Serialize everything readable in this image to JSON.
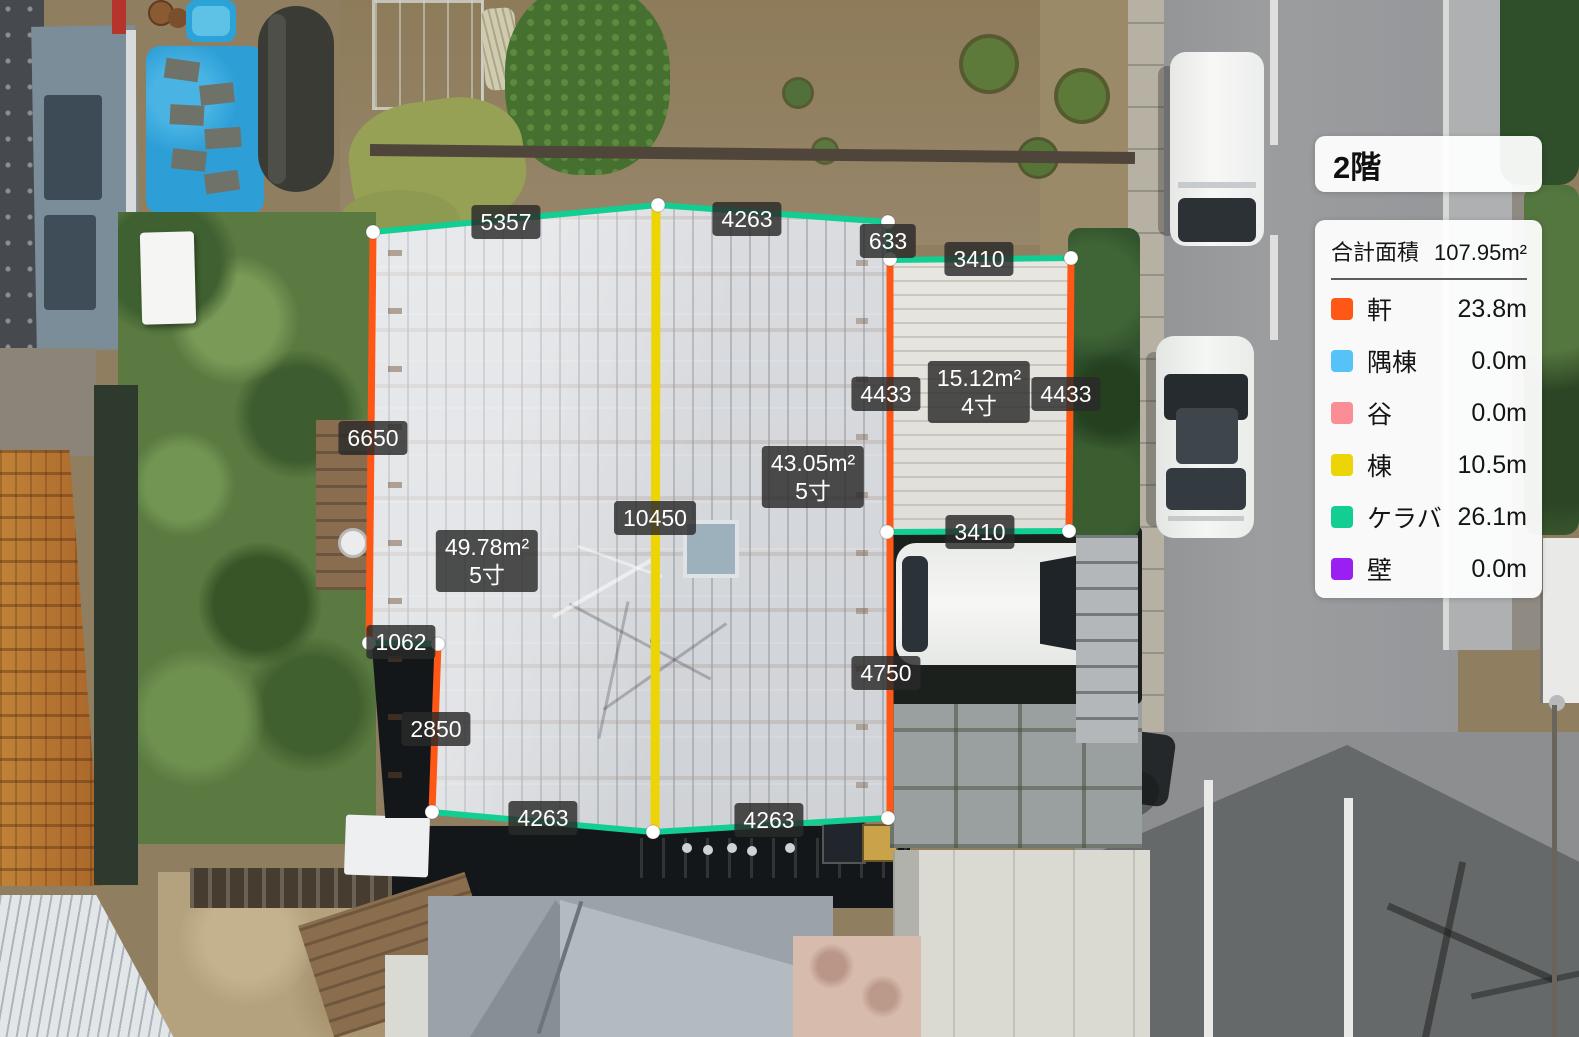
{
  "floor_panel": {
    "title": "2階"
  },
  "legend": {
    "total_label": "合計面積",
    "total_value": "107.95m²",
    "items": [
      {
        "key": "eave",
        "name": "軒",
        "value": "23.8m",
        "color": "#FF5716"
      },
      {
        "key": "hip-ridge",
        "name": "隅棟",
        "value": "0.0m",
        "color": "#55C3F8"
      },
      {
        "key": "valley",
        "name": "谷",
        "value": "0.0m",
        "color": "#FB8D96"
      },
      {
        "key": "ridge",
        "name": "棟",
        "value": "10.5m",
        "color": "#EDD405"
      },
      {
        "key": "gable",
        "name": "ケラバ",
        "value": "26.1m",
        "color": "#12CE92"
      },
      {
        "key": "wall",
        "name": "壁",
        "value": "0.0m",
        "color": "#9B1FF2"
      }
    ]
  },
  "overlay": {
    "edge_colors": {
      "eave": "#FF5716",
      "ridge": "#EDD405",
      "gable": "#12CE92"
    },
    "edge_widths": {
      "eave": 7,
      "ridge": 9,
      "gable": 6
    },
    "edges": [
      {
        "type": "gable",
        "x1": 373,
        "y1": 232,
        "x2": 658,
        "y2": 205
      },
      {
        "type": "gable",
        "x1": 658,
        "y1": 205,
        "x2": 888,
        "y2": 222
      },
      {
        "type": "gable",
        "x1": 888,
        "y1": 222,
        "x2": 890,
        "y2": 258
      },
      {
        "type": "eave",
        "x1": 373,
        "y1": 232,
        "x2": 369,
        "y2": 643
      },
      {
        "type": "gable",
        "x1": 369,
        "y1": 643,
        "x2": 438,
        "y2": 644
      },
      {
        "type": "eave",
        "x1": 438,
        "y1": 644,
        "x2": 432,
        "y2": 812
      },
      {
        "type": "gable",
        "x1": 432,
        "y1": 812,
        "x2": 653,
        "y2": 832
      },
      {
        "type": "gable",
        "x1": 653,
        "y1": 832,
        "x2": 888,
        "y2": 818
      },
      {
        "type": "eave",
        "x1": 890,
        "y1": 258,
        "x2": 890,
        "y2": 818
      },
      {
        "type": "ridge",
        "x1": 656,
        "y1": 207,
        "x2": 655,
        "y2": 830
      },
      {
        "type": "gable",
        "x1": 889,
        "y1": 260,
        "x2": 1071,
        "y2": 258
      },
      {
        "type": "eave",
        "x1": 1071,
        "y1": 258,
        "x2": 1069,
        "y2": 531
      },
      {
        "type": "gable",
        "x1": 887,
        "y1": 532,
        "x2": 1069,
        "y2": 531
      }
    ],
    "vertices": [
      [
        373,
        232
      ],
      [
        658,
        205
      ],
      [
        888,
        222
      ],
      [
        890,
        259
      ],
      [
        369,
        643
      ],
      [
        438,
        644
      ],
      [
        432,
        812
      ],
      [
        653,
        832
      ],
      [
        888,
        818
      ],
      [
        1071,
        258
      ],
      [
        1069,
        531
      ],
      [
        887,
        532
      ]
    ],
    "labels": [
      {
        "x": 506,
        "y": 222,
        "lines": [
          "5357"
        ]
      },
      {
        "x": 747,
        "y": 219,
        "lines": [
          "4263"
        ]
      },
      {
        "x": 888,
        "y": 241,
        "lines": [
          "633"
        ]
      },
      {
        "x": 979,
        "y": 259,
        "lines": [
          "3410"
        ]
      },
      {
        "x": 373,
        "y": 438,
        "lines": [
          "6650"
        ]
      },
      {
        "x": 886,
        "y": 394,
        "lines": [
          "4433"
        ]
      },
      {
        "x": 979,
        "y": 392,
        "lines": [
          "15.12m²",
          "4寸"
        ]
      },
      {
        "x": 1066,
        "y": 394,
        "lines": [
          "4433"
        ]
      },
      {
        "x": 813,
        "y": 477,
        "lines": [
          "43.05m²",
          "5寸"
        ]
      },
      {
        "x": 655,
        "y": 518,
        "lines": [
          "10450"
        ]
      },
      {
        "x": 487,
        "y": 561,
        "lines": [
          "49.78m²",
          "5寸"
        ]
      },
      {
        "x": 980,
        "y": 532,
        "lines": [
          "3410"
        ]
      },
      {
        "x": 401,
        "y": 642,
        "lines": [
          "1062"
        ]
      },
      {
        "x": 886,
        "y": 673,
        "lines": [
          "4750"
        ]
      },
      {
        "x": 436,
        "y": 729,
        "lines": [
          "2850"
        ]
      },
      {
        "x": 543,
        "y": 818,
        "lines": [
          "4263"
        ]
      },
      {
        "x": 769,
        "y": 820,
        "lines": [
          "4263"
        ]
      }
    ]
  }
}
